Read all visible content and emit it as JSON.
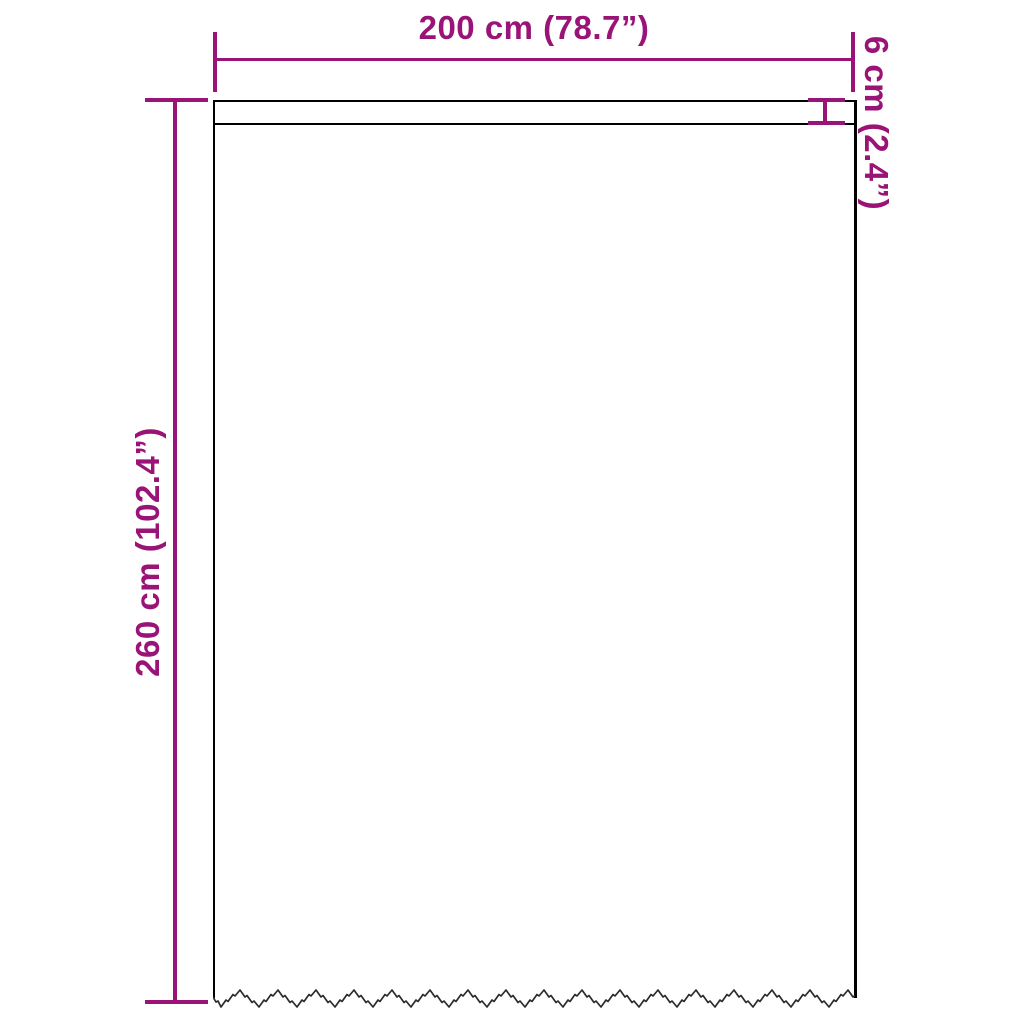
{
  "diagram": {
    "type": "product-dimension-diagram",
    "background_color": "#ffffff",
    "accent_color": "#9A1477",
    "outline_color": "#000000",
    "dimensions": {
      "width": {
        "label": "200 cm (78.7”)",
        "position": "top"
      },
      "height": {
        "label": "260 cm (102.4”)",
        "position": "left"
      },
      "band": {
        "label": "6 cm (2.4”)",
        "position": "top-right"
      }
    },
    "product": {
      "shape": "curtain panel with top rod-pocket band and serrated bottom edge"
    }
  }
}
